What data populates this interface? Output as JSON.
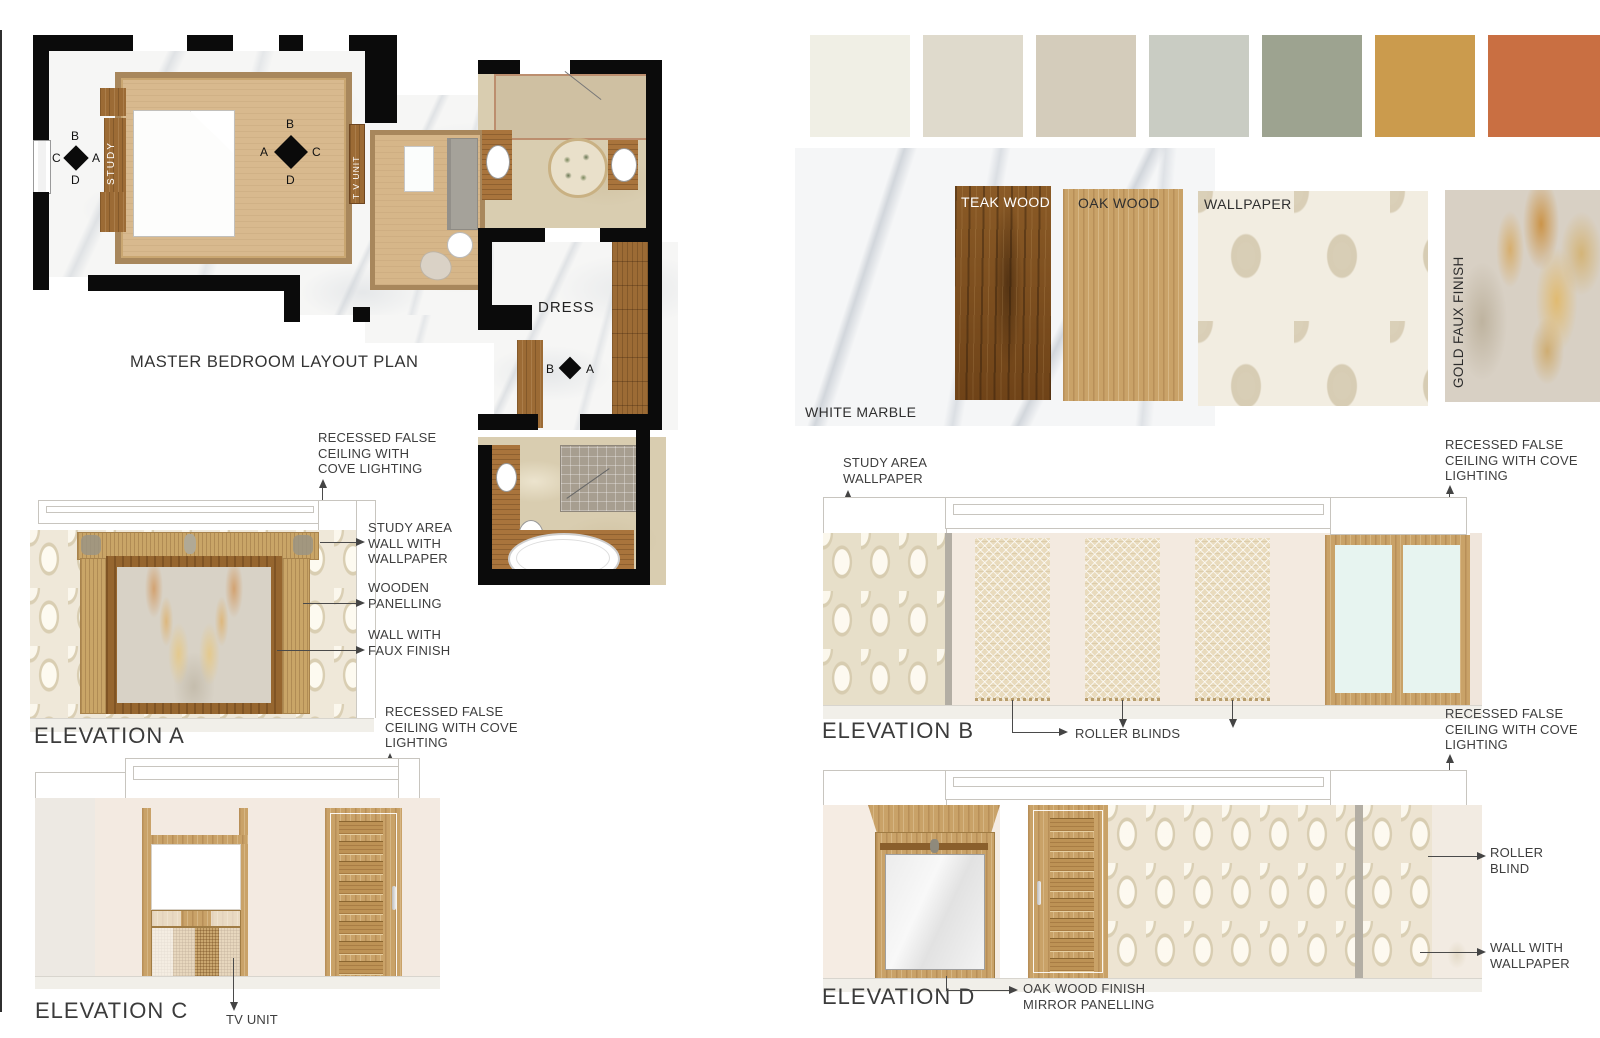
{
  "board": {
    "plan": {
      "title": "MASTER BEDROOM LAYOUT PLAN",
      "labels": {
        "study": "STUDY",
        "tv_unit": "T V UNIT",
        "dress": "DRESS"
      },
      "markers": {
        "study_wall": {
          "top": "B",
          "left": "C",
          "right": "A",
          "bottom": "D"
        },
        "bedroom_center": {
          "top": "B",
          "left": "A",
          "right": "C",
          "bottom": "D"
        },
        "dress": {
          "left": "B",
          "right": "A"
        }
      }
    },
    "palette": [
      {
        "name": "ivory",
        "hex": "#F0EFE5"
      },
      {
        "name": "light-beige",
        "hex": "#DFDACC"
      },
      {
        "name": "taupe",
        "hex": "#D4CCBB"
      },
      {
        "name": "light-gray",
        "hex": "#C9CCC3"
      },
      {
        "name": "sage-green",
        "hex": "#9DA390"
      },
      {
        "name": "mustard-gold",
        "hex": "#CB9B4D"
      },
      {
        "name": "terracotta",
        "hex": "#C96F42"
      }
    ],
    "materials": {
      "white_marble": "WHITE MARBLE",
      "teak_wood": "TEAK WOOD",
      "oak_wood": "OAK WOOD",
      "wallpaper": "WALLPAPER",
      "gold_faux_finish": "GOLD FAUX FINISH"
    },
    "elevations": {
      "a": {
        "title": "ELEVATION A",
        "ann_ceiling": [
          "RECESSED FALSE",
          "CEILING WITH",
          "COVE LIGHTING"
        ],
        "ann_wallpaper": [
          "STUDY AREA",
          "WALL WITH",
          "WALLPAPER"
        ],
        "ann_panelling": [
          "WOODEN",
          "PANELLING"
        ],
        "ann_faux": [
          "WALL WITH",
          "FAUX FINISH"
        ]
      },
      "b": {
        "title": "ELEVATION B",
        "ann_wallpaper": [
          "STUDY AREA",
          "WALLPAPER"
        ],
        "ann_ceiling": [
          "RECESSED FALSE",
          "CEILING WITH COVE",
          "LIGHTING"
        ],
        "ann_blinds": "ROLLER BLINDS"
      },
      "c": {
        "title": "ELEVATION C",
        "ann_ceiling": [
          "RECESSED FALSE",
          "CEILING WITH COVE",
          "LIGHTING"
        ],
        "ann_tv": "TV UNIT"
      },
      "d": {
        "title": "ELEVATION D",
        "ann_ceiling": [
          "RECESSED FALSE",
          "CEILING WITH COVE",
          "LIGHTING"
        ],
        "ann_mirror": [
          "OAK WOOD FINISH",
          "MIRROR PANELLING"
        ],
        "ann_blind": [
          "ROLLER",
          "BLIND"
        ],
        "ann_wallpaper": [
          "WALL WITH",
          "WALLPAPER"
        ]
      }
    }
  }
}
